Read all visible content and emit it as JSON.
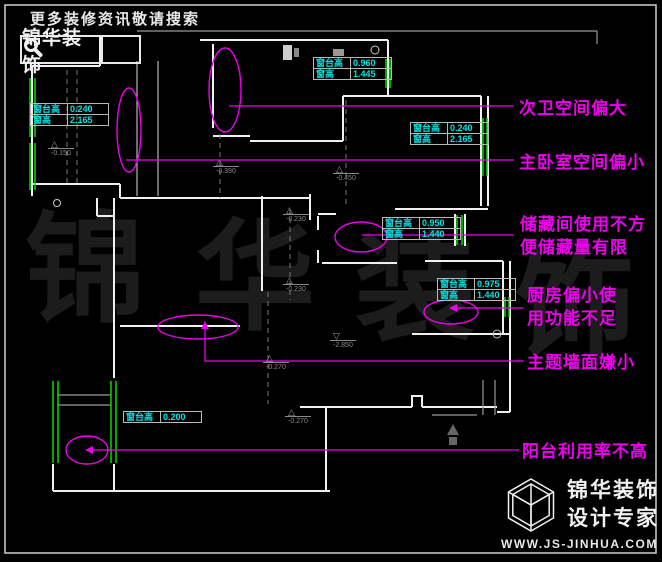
{
  "header": {
    "tagline": "更多装修资讯敬请搜索",
    "logo_text": "锦华装饰"
  },
  "annotations": {
    "labels": [
      {
        "lines": [
          "次卫空间偏大"
        ]
      },
      {
        "lines": [
          "主卧室空间偏小"
        ]
      },
      {
        "lines": [
          "储藏间使用不方",
          "便储藏量有限"
        ]
      },
      {
        "lines": [
          "厨房偏小使",
          "用功能不足"
        ]
      },
      {
        "lines": [
          "主题墙面嫌小"
        ]
      },
      {
        "lines": [
          "阳台利用率不高"
        ]
      }
    ]
  },
  "window_tables": [
    {
      "rows": [
        [
          "窗台高",
          "0.240"
        ],
        [
          "窗高",
          "2.165"
        ]
      ]
    },
    {
      "rows": [
        [
          "窗台高",
          "0.960"
        ],
        [
          "窗高",
          "1.445"
        ]
      ]
    },
    {
      "rows": [
        [
          "窗台高",
          "0.240"
        ],
        [
          "窗高",
          "2.165"
        ]
      ]
    },
    {
      "rows": [
        [
          "窗台高",
          "0.950"
        ],
        [
          "窗高",
          "1.440"
        ]
      ]
    },
    {
      "rows": [
        [
          "窗台高",
          "0.975"
        ],
        [
          "窗高",
          "1.440"
        ]
      ]
    },
    {
      "rows": [
        [
          "窗台高",
          "0.200"
        ]
      ]
    }
  ],
  "elevation_markers": [
    {
      "value": "-0.150"
    },
    {
      "value": "-0.390"
    },
    {
      "value": "-0.450"
    },
    {
      "value": "-0.230"
    },
    {
      "value": "-0.230"
    },
    {
      "value": "-2.850"
    },
    {
      "value": "-0.270"
    },
    {
      "value": "-0.270"
    }
  ],
  "watermark": {
    "chars": [
      "锦",
      "华",
      "装",
      "饰"
    ]
  },
  "footer": {
    "company": "锦华装饰",
    "slogan": "设计专家",
    "website": "WWW.JS-JINHUA.COM"
  },
  "colors": {
    "annotation": "#ee00ee",
    "dimension_text": "#00e5e5",
    "window_marker": "#00dd00",
    "wall": "#f0f0f0",
    "background": "#000000"
  }
}
